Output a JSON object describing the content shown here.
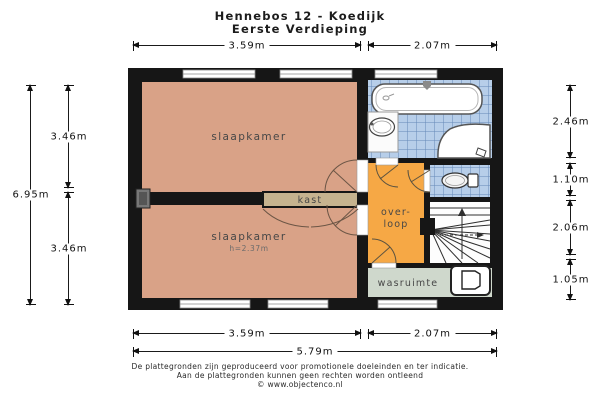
{
  "title": {
    "line1": "Hennebos 12 - Koedijk",
    "line2": "Eerste Verdieping"
  },
  "rooms": {
    "bedroom_top": "slaapkamer",
    "bedroom_bottom": "slaapkamer",
    "bedroom_bottom_height": "h=2.37m",
    "closet": "kast",
    "landing_line1": "over-",
    "landing_line2": "loop",
    "laundry": "wasruimte"
  },
  "dim": {
    "top": [
      "3.59m",
      "2.07m"
    ],
    "bottom": [
      "3.59m",
      "2.07m"
    ],
    "bottom_total": "5.79m",
    "left_total": "6.95m",
    "left": [
      "3.46m",
      "3.46m"
    ],
    "right": [
      "2.46m",
      "1.10m",
      "2.06m",
      "1.05m"
    ]
  },
  "footer": {
    "line1": "De plattegronden zijn geproduceerd voor promotionele doeleinden en ter indicatie.",
    "line2": "Aan de plattegronden kunnen geen rechten worden ontleend",
    "line3": "© www.objectenco.nl"
  },
  "colors": {
    "wall": "#161616",
    "bedroom": "#D9A287",
    "closet": "#C6B38F",
    "landing": "#F6A845",
    "laundry": "#CFD8CC",
    "tile": "#B7CEE9",
    "tile_grid": "#6488B8"
  },
  "fixtures": [
    "bathtub",
    "washbasin",
    "corner-bath",
    "toilet",
    "stairs",
    "washing-machine",
    "chimney-duct"
  ]
}
